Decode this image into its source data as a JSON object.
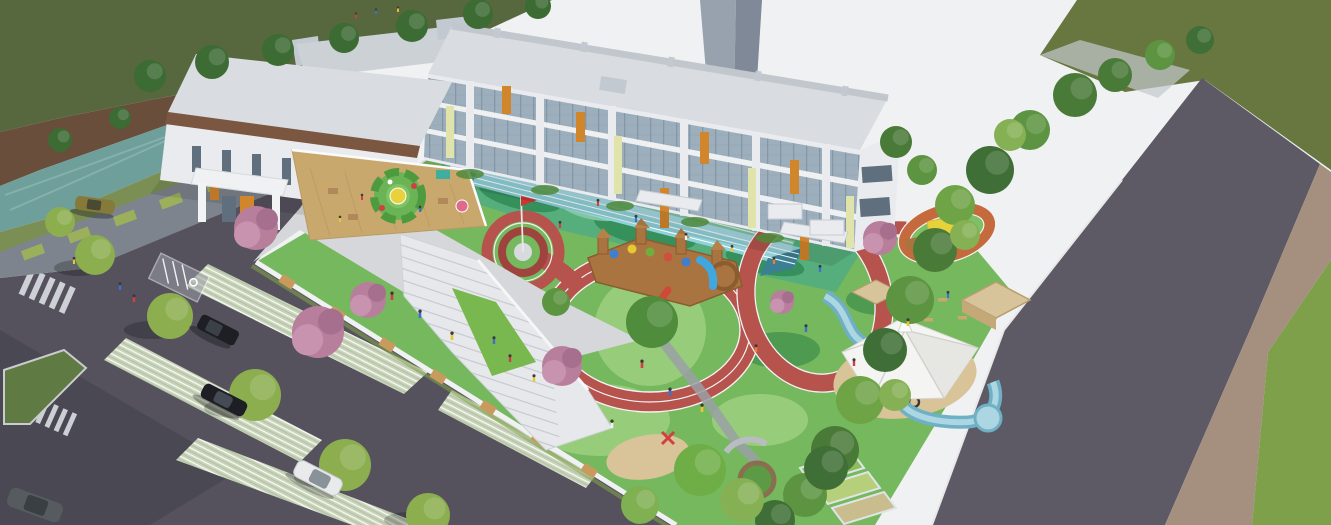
{
  "scene": {
    "title": "Aerial rendering of a kindergarten campus",
    "type": "3d-architectural-rendering",
    "view": "bird's-eye perspective, light from upper right, long shadows to lower left"
  },
  "palette": {
    "sky": "#eff1f2",
    "lawnDark": "#57673e",
    "lawnOlive": "#68763f",
    "grassBright": "#7fa04b",
    "water": "#6f9f9a",
    "bankBrown": "#6a4e3c",
    "fenceGray": "#7e848d",
    "fencePanel": "#9cb05c",
    "asphalt": "#55525e",
    "asphaltRoad": "#5d5a66",
    "pavement": "#d5d7da",
    "buildingWall": "#e9ebee",
    "buildingGray": "#c3c9d0",
    "roofLight": "#d9dde1",
    "glass": "#9dafbd",
    "glassDark": "#5f6f7e",
    "accentOrange": "#d2862b",
    "accentYellow": "#e0e3aa",
    "brownBand": "#7b5742",
    "deckWood": "#c9a86e",
    "stairWhite": "#e6e8eb",
    "courtGreen": "#55ae7c",
    "courtDark": "#35905c",
    "laneBlue": "#8fd2da",
    "laneDark": "#3b7f92",
    "trackRed": "#b5534c",
    "trackDark": "#9e433e",
    "miniTrackOrange": "#c56a3c",
    "playGreen": "#76b85e",
    "playLight": "#97cd7a",
    "playDark": "#4e9a50",
    "sand": "#d9c499",
    "canopyWhite": "#f4f4f2",
    "canopyYellow": "#e8d23c",
    "streamBlue": "#6fb0c6",
    "streamLight": "#abd6e2",
    "wood": "#a9743f",
    "woodDark": "#8a5c30",
    "blossomPink": "#b87f9d",
    "treeDark": "#3f6f36",
    "treeMid": "#5d9441",
    "treeLight": "#7fae4e",
    "treeYellow": "#93b453",
    "sidewalkTan": "#a5907f",
    "towerGray": "#98a1ae",
    "carBlack": "#1d1f24",
    "carWhite": "#e8eaec",
    "carGray": "#565b60",
    "carOlive": "#857a3a",
    "flagRed": "#cf3430",
    "slideBlue": "#3fa8e0",
    "slideRed": "#d04838"
  },
  "elements": {
    "building": "three-story kindergarten building, white with glass curtain wall, orange and pale-yellow accent fins",
    "tower": "tall gray high-rise silhouette behind the roof",
    "rooftopTerrace": "wooden roof deck with circular green play maze and yellow table",
    "grandStaircase": "wide white sculptural staircase with green lawn wedge",
    "courtyard": "green rubber court with straight blue running lanes and flagpole with red flag",
    "flag": "red flag on white pole over concentric red rings",
    "playTrack": "looping red running track with white lane lines through playground",
    "miniTrack": "small orange oval track with yellow pavilion",
    "playCastle": "wooden play castle with colorful portholes, blue tube slide and red slide",
    "shadeSail": "white tensile canopy over sand pit with tires",
    "stream": "winding blue water-play channel",
    "gardenTerraces": "stepped planting beds and round planter at the south corner",
    "parking": "asphalt lot with grass-paver stalls, zebra crossings and accessible stall",
    "cars": [
      "black SUV",
      "black sedan",
      "white hatchback",
      "gray car",
      "olive car"
    ],
    "canal": "tree-lined water canal along the north-west edge",
    "fences": "white fence with timber infill around the playground; gray fence with green mesh along the canal",
    "road": "curving asphalt road with tan sidewalk on the east side",
    "treeBelts": "dense green tree belts on east boundary, street trees at parking",
    "blossoms": "pink flowering trees inside the yard",
    "people": "small figures of children and adults across plaza, courtyard and playground"
  }
}
